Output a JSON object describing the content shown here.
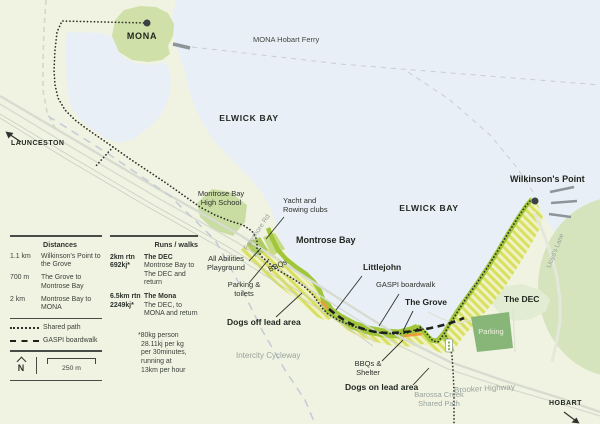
{
  "map": {
    "mona": "MONA",
    "ferry_route": "MONA Hobart Ferry",
    "bay_north": "ELWICK BAY",
    "bay_east": "ELWICK BAY",
    "launceston": "LAUNCESTON",
    "school": [
      "Montrose Bay",
      "High School"
    ],
    "foreshore_rd": "Foreshore Rd",
    "yacht_club": [
      "Yacht and",
      "Rowing clubs"
    ],
    "montrose_bay": "Montrose Bay",
    "wilkinsons_point": "Wilkinson's Point",
    "lloyds_lane": "Lloyd's Lane",
    "playground": [
      "All Abilities",
      "Playground"
    ],
    "bbqs": "BBQs",
    "parking_toilets": [
      "Parking &",
      "toilets"
    ],
    "dogs_off_lead": "Dogs off lead area",
    "intercity_cycleway": "Intercity Cycleway",
    "littlejohn": "Littlejohn",
    "gaspi_boardwalk": "GASPI boardwalk",
    "the_grove": "The Grove",
    "the_dec": "The DEC",
    "parking": "Parking",
    "bbqs_shelter": [
      "BBQs &",
      "Shelter"
    ],
    "dogs_on_lead": "Dogs on lead area",
    "barossa_creek": [
      "Barossa Creek",
      "Shared Path"
    ],
    "brooker_highway": "Brooker Highway",
    "hobart": "HOBART"
  },
  "legend": {
    "distances": {
      "title": "Distances",
      "rows": [
        {
          "value": "1.1 km",
          "label": "Wilkinson's Point to the Grove"
        },
        {
          "value": "700 m",
          "label": "The Grove to Montrose Bay"
        },
        {
          "value": "2 km",
          "label": "Montrose Bay to MONA"
        }
      ],
      "lines": [
        {
          "label": "Shared path"
        },
        {
          "label": "GASPI boardwalk"
        }
      ],
      "north_letter": "N",
      "scale_label": "250 m"
    },
    "runs": {
      "title": "Runs / walks",
      "rows": [
        {
          "distance": "2km rtn",
          "energy": "692kj*",
          "name": "The DEC",
          "desc": "Montrose Bay to The DEC and return"
        },
        {
          "distance": "6.5km rtn",
          "energy": "2249kj*",
          "name": "The Mona",
          "desc": "The DEC, to MONA and return"
        }
      ],
      "footnote": [
        "*80kg person",
        "28.11kj per kg",
        "per 30minutes,",
        "running at",
        "13km per hour"
      ]
    }
  },
  "colors": {
    "land": "#f1f3e2",
    "water": "#e8eff6",
    "park_green": "#cfe0a8",
    "light_green": "#e2ecd2",
    "circle_green": "#d5e4bd",
    "shore_green": "#a1c63a",
    "hatch_stripe": "#d9e061",
    "hatch_bg": "#eff2c4",
    "parking_green": "#87b678",
    "orange_marker": "#ef9a3d",
    "path_dark": "#2c312c",
    "road_gray": "#d7dbd0",
    "cycleway_gray": "#c4cdd7",
    "label_gray": "#98a39b"
  }
}
